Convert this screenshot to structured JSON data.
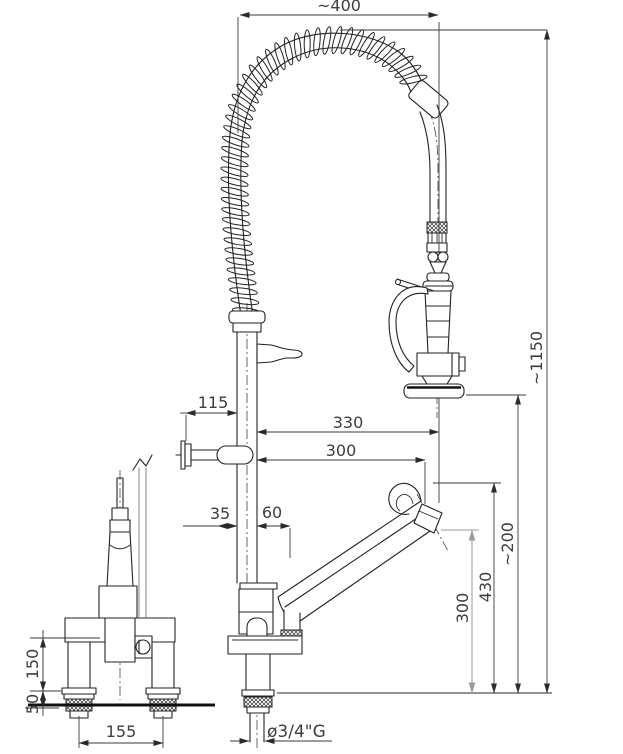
{
  "colors": {
    "line": "#222222",
    "dimension": "#3a3a3a",
    "dimension_gray": "#9a9a9a"
  },
  "dims": {
    "top_width": "~400",
    "total_height": "~1150",
    "bracket_offset": "115",
    "reach_outer": "330",
    "reach_inner": "300",
    "offset_left": "35",
    "offset_right": "60",
    "spout_top_height": "430",
    "spout_outlet_height": "300",
    "head_clearance": "~200",
    "side_body_height": "150",
    "deck_thickness": "50",
    "hole_spacing": "155",
    "connection_thread": "ø3/4\"G"
  }
}
